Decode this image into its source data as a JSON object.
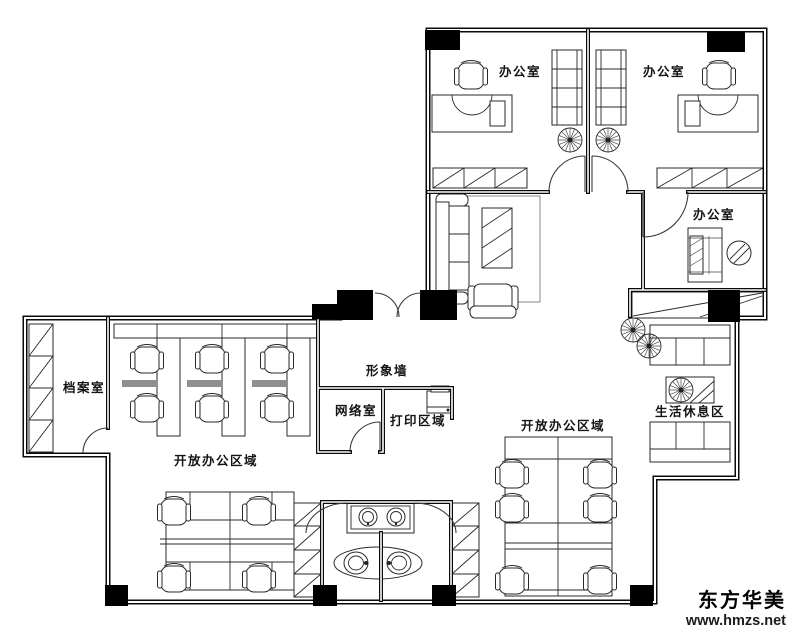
{
  "rooms": {
    "office_top_left": "办公室",
    "office_top_right": "办公室",
    "office_side": "办公室",
    "archive_room": "档案室",
    "image_wall": "形象墙",
    "network_room": "网络室",
    "print_area": "打印区域",
    "open_office_left": "开放办公区域",
    "open_office_right": "开放办公区域",
    "rest_area": "生活休息区"
  },
  "watermark": {
    "brand": "东方华美",
    "url": "www.hmzs.net"
  },
  "colors": {
    "background": "#ffffff",
    "wall": "#0a0a0a",
    "line": "#2a2a2a",
    "column": "#000000",
    "text": "#141414"
  }
}
